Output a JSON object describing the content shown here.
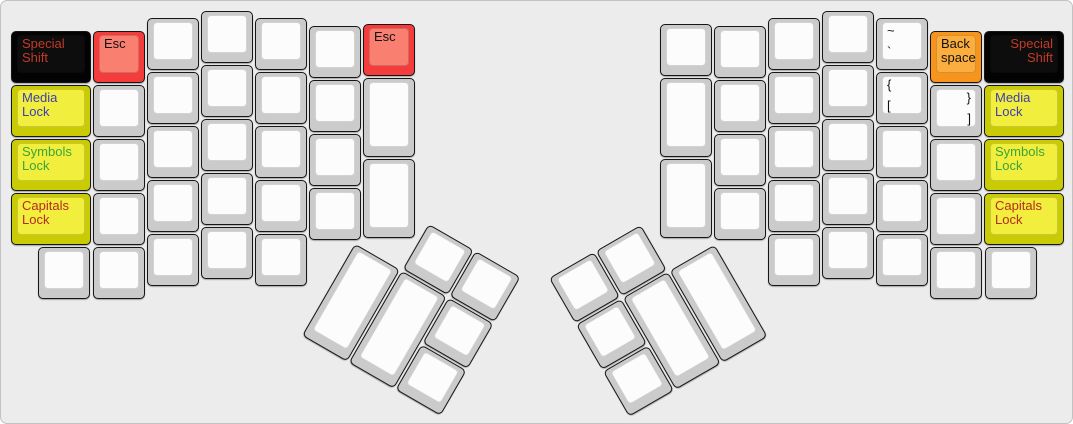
{
  "canvas": {
    "width": 1073,
    "height": 424,
    "background": "#ececec",
    "border_color": "#c2c2c2"
  },
  "palette": {
    "white": {
      "side": "#cbcbcb",
      "top": "#fcfcfc"
    },
    "black": {
      "side": "#030303",
      "top": "#0d0d0d"
    },
    "red": {
      "side": "#f43c3c",
      "top": "#f97f71"
    },
    "yellow": {
      "side": "#c9cc04",
      "top": "#f1ee3e"
    },
    "orange": {
      "side": "#f7941d",
      "top": "#fbae3e"
    }
  },
  "legend_colors": {
    "default": "#111111",
    "special": "#c33b28",
    "media": "#3e3eb0",
    "symbols": "#3aa53a",
    "capitals": "#b32d1f"
  },
  "keys": [
    {
      "name": "special-shift-left",
      "x": 10,
      "y": 30,
      "w": 80,
      "h": 52,
      "color": "black",
      "legends": [
        {
          "text": "Special\nShift",
          "pos": "tl",
          "color": "special"
        }
      ]
    },
    {
      "name": "media-lock-left",
      "x": 10,
      "y": 84,
      "w": 80,
      "h": 52,
      "color": "yellow",
      "legends": [
        {
          "text": "Media\nLock",
          "pos": "tl",
          "color": "media"
        }
      ]
    },
    {
      "name": "symbols-lock-left",
      "x": 10,
      "y": 138,
      "w": 80,
      "h": 52,
      "color": "yellow",
      "legends": [
        {
          "text": "Symbols\nLock",
          "pos": "tl",
          "color": "symbols"
        }
      ]
    },
    {
      "name": "capitals-lock-left",
      "x": 10,
      "y": 192,
      "w": 80,
      "h": 52,
      "color": "yellow",
      "legends": [
        {
          "text": "Capitals\nLock",
          "pos": "tl",
          "color": "capitals"
        }
      ]
    },
    {
      "name": "esc-left",
      "x": 92,
      "y": 30,
      "w": 52,
      "h": 52,
      "color": "red",
      "legends": [
        {
          "text": "Esc",
          "pos": "tl",
          "color": "default"
        }
      ]
    },
    {
      "name": "key-left-c1-r2",
      "x": 92,
      "y": 84,
      "w": 52,
      "h": 52,
      "color": "white",
      "legends": []
    },
    {
      "name": "key-left-c1-r3",
      "x": 92,
      "y": 138,
      "w": 52,
      "h": 52,
      "color": "white",
      "legends": []
    },
    {
      "name": "key-left-c1-r4",
      "x": 92,
      "y": 192,
      "w": 52,
      "h": 52,
      "color": "white",
      "legends": []
    },
    {
      "name": "key-left-c1-r5",
      "x": 92,
      "y": 246,
      "w": 52,
      "h": 52,
      "color": "white",
      "legends": []
    },
    {
      "name": "key-left-c0-r5",
      "x": 37,
      "y": 246,
      "w": 52,
      "h": 52,
      "color": "white",
      "legends": []
    },
    {
      "name": "key-left-c2-r1",
      "x": 146,
      "y": 17,
      "w": 52,
      "h": 52,
      "color": "white",
      "legends": []
    },
    {
      "name": "key-left-c2-r2",
      "x": 146,
      "y": 71,
      "w": 52,
      "h": 52,
      "color": "white",
      "legends": []
    },
    {
      "name": "key-left-c2-r3",
      "x": 146,
      "y": 125,
      "w": 52,
      "h": 52,
      "color": "white",
      "legends": []
    },
    {
      "name": "key-left-c2-r4",
      "x": 146,
      "y": 179,
      "w": 52,
      "h": 52,
      "color": "white",
      "legends": []
    },
    {
      "name": "key-left-c2-r5",
      "x": 146,
      "y": 233,
      "w": 52,
      "h": 52,
      "color": "white",
      "legends": []
    },
    {
      "name": "key-left-c3-r1",
      "x": 200,
      "y": 10,
      "w": 52,
      "h": 52,
      "color": "white",
      "legends": []
    },
    {
      "name": "key-left-c3-r2",
      "x": 200,
      "y": 64,
      "w": 52,
      "h": 52,
      "color": "white",
      "legends": []
    },
    {
      "name": "key-left-c3-r3",
      "x": 200,
      "y": 118,
      "w": 52,
      "h": 52,
      "color": "white",
      "legends": []
    },
    {
      "name": "key-left-c3-r4",
      "x": 200,
      "y": 172,
      "w": 52,
      "h": 52,
      "color": "white",
      "legends": []
    },
    {
      "name": "key-left-c3-r5",
      "x": 200,
      "y": 226,
      "w": 52,
      "h": 52,
      "color": "white",
      "legends": []
    },
    {
      "name": "key-left-c4-r1",
      "x": 254,
      "y": 17,
      "w": 52,
      "h": 52,
      "color": "white",
      "legends": []
    },
    {
      "name": "key-left-c4-r2",
      "x": 254,
      "y": 71,
      "w": 52,
      "h": 52,
      "color": "white",
      "legends": []
    },
    {
      "name": "key-left-c4-r3",
      "x": 254,
      "y": 125,
      "w": 52,
      "h": 52,
      "color": "white",
      "legends": []
    },
    {
      "name": "key-left-c4-r4",
      "x": 254,
      "y": 179,
      "w": 52,
      "h": 52,
      "color": "white",
      "legends": []
    },
    {
      "name": "key-left-c4-r5",
      "x": 254,
      "y": 233,
      "w": 52,
      "h": 52,
      "color": "white",
      "legends": []
    },
    {
      "name": "key-left-c5-r1",
      "x": 308,
      "y": 25,
      "w": 52,
      "h": 52,
      "color": "white",
      "legends": []
    },
    {
      "name": "key-left-c5-r2",
      "x": 308,
      "y": 79,
      "w": 52,
      "h": 52,
      "color": "white",
      "legends": []
    },
    {
      "name": "key-left-c5-r3",
      "x": 308,
      "y": 133,
      "w": 52,
      "h": 52,
      "color": "white",
      "legends": []
    },
    {
      "name": "key-left-c5-r4",
      "x": 308,
      "y": 187,
      "w": 52,
      "h": 52,
      "color": "white",
      "legends": []
    },
    {
      "name": "esc-left-inner",
      "x": 362,
      "y": 23,
      "w": 52,
      "h": 52,
      "color": "red",
      "legends": [
        {
          "text": "Esc",
          "pos": "tl",
          "color": "default"
        }
      ]
    },
    {
      "name": "key-left-c6-r2",
      "x": 362,
      "y": 77,
      "w": 52,
      "h": 79,
      "color": "white",
      "legends": []
    },
    {
      "name": "key-left-c6-r3",
      "x": 362,
      "y": 158,
      "w": 52,
      "h": 79,
      "color": "white",
      "legends": []
    },
    {
      "name": "key-right-c6-r1",
      "x": 659,
      "y": 23,
      "w": 52,
      "h": 52,
      "color": "white",
      "legends": []
    },
    {
      "name": "key-right-c6-r2",
      "x": 659,
      "y": 77,
      "w": 52,
      "h": 79,
      "color": "white",
      "legends": []
    },
    {
      "name": "key-right-c6-r3",
      "x": 659,
      "y": 158,
      "w": 52,
      "h": 79,
      "color": "white",
      "legends": []
    },
    {
      "name": "key-right-c5-r1",
      "x": 713,
      "y": 25,
      "w": 52,
      "h": 52,
      "color": "white",
      "legends": []
    },
    {
      "name": "key-right-c5-r2",
      "x": 713,
      "y": 79,
      "w": 52,
      "h": 52,
      "color": "white",
      "legends": []
    },
    {
      "name": "key-right-c5-r3",
      "x": 713,
      "y": 133,
      "w": 52,
      "h": 52,
      "color": "white",
      "legends": []
    },
    {
      "name": "key-right-c5-r4",
      "x": 713,
      "y": 187,
      "w": 52,
      "h": 52,
      "color": "white",
      "legends": []
    },
    {
      "name": "key-right-c4-r1",
      "x": 767,
      "y": 17,
      "w": 52,
      "h": 52,
      "color": "white",
      "legends": []
    },
    {
      "name": "key-right-c4-r2",
      "x": 767,
      "y": 71,
      "w": 52,
      "h": 52,
      "color": "white",
      "legends": []
    },
    {
      "name": "key-right-c4-r3",
      "x": 767,
      "y": 125,
      "w": 52,
      "h": 52,
      "color": "white",
      "legends": []
    },
    {
      "name": "key-right-c4-r4",
      "x": 767,
      "y": 179,
      "w": 52,
      "h": 52,
      "color": "white",
      "legends": []
    },
    {
      "name": "key-right-c4-r5",
      "x": 767,
      "y": 233,
      "w": 52,
      "h": 52,
      "color": "white",
      "legends": []
    },
    {
      "name": "key-right-c3-r1",
      "x": 821,
      "y": 10,
      "w": 52,
      "h": 52,
      "color": "white",
      "legends": []
    },
    {
      "name": "key-right-c3-r2",
      "x": 821,
      "y": 64,
      "w": 52,
      "h": 52,
      "color": "white",
      "legends": []
    },
    {
      "name": "key-right-c3-r3",
      "x": 821,
      "y": 118,
      "w": 52,
      "h": 52,
      "color": "white",
      "legends": []
    },
    {
      "name": "key-right-c3-r4",
      "x": 821,
      "y": 172,
      "w": 52,
      "h": 52,
      "color": "white",
      "legends": []
    },
    {
      "name": "key-right-c3-r5",
      "x": 821,
      "y": 226,
      "w": 52,
      "h": 52,
      "color": "white",
      "legends": []
    },
    {
      "name": "tilde-key",
      "x": 875,
      "y": 17,
      "w": 52,
      "h": 52,
      "color": "white",
      "legends": [
        {
          "text": "~",
          "pos": "tl",
          "color": "default"
        },
        {
          "text": "`",
          "pos": "bl",
          "color": "default"
        }
      ]
    },
    {
      "name": "bracket-open-key",
      "x": 875,
      "y": 71,
      "w": 52,
      "h": 52,
      "color": "white",
      "legends": [
        {
          "text": "{",
          "pos": "tl",
          "color": "default"
        },
        {
          "text": "[",
          "pos": "bl",
          "color": "default"
        }
      ]
    },
    {
      "name": "key-right-c2-r3",
      "x": 875,
      "y": 125,
      "w": 52,
      "h": 52,
      "color": "white",
      "legends": []
    },
    {
      "name": "key-right-c2-r4",
      "x": 875,
      "y": 179,
      "w": 52,
      "h": 52,
      "color": "white",
      "legends": []
    },
    {
      "name": "key-right-c2-r5",
      "x": 875,
      "y": 233,
      "w": 52,
      "h": 52,
      "color": "white",
      "legends": []
    },
    {
      "name": "backspace-key",
      "x": 929,
      "y": 30,
      "w": 52,
      "h": 52,
      "color": "orange",
      "legends": [
        {
          "text": "Back\nspace",
          "pos": "tl",
          "color": "default"
        }
      ]
    },
    {
      "name": "bracket-close-key",
      "x": 929,
      "y": 84,
      "w": 52,
      "h": 52,
      "color": "white",
      "legends": [
        {
          "text": "}",
          "pos": "tr",
          "color": "default"
        },
        {
          "text": "]",
          "pos": "br",
          "color": "default"
        }
      ]
    },
    {
      "name": "key-right-c1-r3",
      "x": 929,
      "y": 138,
      "w": 52,
      "h": 52,
      "color": "white",
      "legends": []
    },
    {
      "name": "key-right-c1-r4",
      "x": 929,
      "y": 192,
      "w": 52,
      "h": 52,
      "color": "white",
      "legends": []
    },
    {
      "name": "key-right-c1-r5",
      "x": 929,
      "y": 246,
      "w": 52,
      "h": 52,
      "color": "white",
      "legends": []
    },
    {
      "name": "key-right-c0-r5",
      "x": 984,
      "y": 246,
      "w": 52,
      "h": 52,
      "color": "white",
      "legends": []
    },
    {
      "name": "special-shift-right",
      "x": 983,
      "y": 30,
      "w": 80,
      "h": 52,
      "color": "black",
      "legends": [
        {
          "text": "Special\nShift",
          "pos": "tr",
          "color": "special"
        }
      ]
    },
    {
      "name": "media-lock-right",
      "x": 983,
      "y": 84,
      "w": 80,
      "h": 52,
      "color": "yellow",
      "legends": [
        {
          "text": "Media\nLock",
          "pos": "tl",
          "color": "media"
        }
      ]
    },
    {
      "name": "symbols-lock-right",
      "x": 983,
      "y": 138,
      "w": 80,
      "h": 52,
      "color": "yellow",
      "legends": [
        {
          "text": "Symbols\nLock",
          "pos": "tl",
          "color": "symbols"
        }
      ]
    },
    {
      "name": "capitals-lock-right",
      "x": 983,
      "y": 192,
      "w": 80,
      "h": 52,
      "color": "yellow",
      "legends": [
        {
          "text": "Capitals\nLock",
          "pos": "tl",
          "color": "capitals"
        }
      ]
    }
  ],
  "clusters": [
    {
      "name": "left-thumb-cluster",
      "x": 381,
      "y": 196,
      "angle": 30,
      "keys": [
        {
          "name": "thumb-left-top-1",
          "x": 54,
          "y": 0,
          "w": 52,
          "h": 52,
          "color": "white",
          "legends": []
        },
        {
          "name": "thumb-left-top-2",
          "x": 108,
          "y": 0,
          "w": 52,
          "h": 52,
          "color": "white",
          "legends": []
        },
        {
          "name": "thumb-left-tall-1",
          "x": 0,
          "y": 54,
          "w": 52,
          "h": 106,
          "color": "white",
          "legends": []
        },
        {
          "name": "thumb-left-tall-2",
          "x": 54,
          "y": 54,
          "w": 52,
          "h": 106,
          "color": "white",
          "legends": []
        },
        {
          "name": "thumb-left-side-1",
          "x": 108,
          "y": 54,
          "w": 52,
          "h": 52,
          "color": "white",
          "legends": []
        },
        {
          "name": "thumb-left-side-2",
          "x": 108,
          "y": 108,
          "w": 52,
          "h": 52,
          "color": "white",
          "legends": []
        }
      ]
    },
    {
      "name": "right-thumb-cluster",
      "x": 548,
      "y": 277,
      "angle": -30,
      "keys": [
        {
          "name": "thumb-right-top-1",
          "x": 0,
          "y": 0,
          "w": 52,
          "h": 52,
          "color": "white",
          "legends": []
        },
        {
          "name": "thumb-right-top-2",
          "x": 54,
          "y": 0,
          "w": 52,
          "h": 52,
          "color": "white",
          "legends": []
        },
        {
          "name": "thumb-right-side-1",
          "x": 0,
          "y": 54,
          "w": 52,
          "h": 52,
          "color": "white",
          "legends": []
        },
        {
          "name": "thumb-right-side-2",
          "x": 0,
          "y": 108,
          "w": 52,
          "h": 52,
          "color": "white",
          "legends": []
        },
        {
          "name": "thumb-right-tall-1",
          "x": 54,
          "y": 54,
          "w": 52,
          "h": 106,
          "color": "white",
          "legends": []
        },
        {
          "name": "thumb-right-tall-2",
          "x": 108,
          "y": 54,
          "w": 52,
          "h": 106,
          "color": "white",
          "legends": []
        }
      ]
    }
  ]
}
